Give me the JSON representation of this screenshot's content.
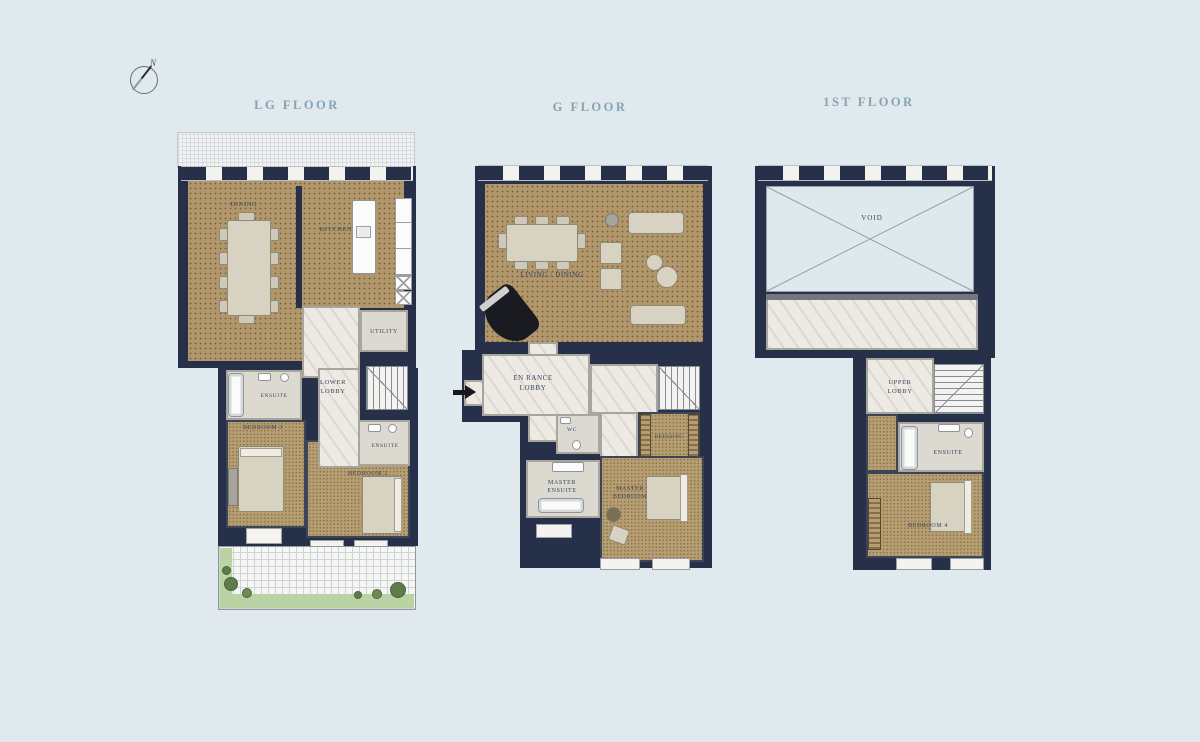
{
  "compass": {
    "north_label": "N"
  },
  "floors": {
    "lg": {
      "title": "LG FLOOR",
      "rooms": {
        "dining": "DINING",
        "kitchen": "KITCHEN",
        "utility": "UTILITY",
        "lower_lobby": "LOWER LOBBY",
        "ensuite_left": "ENSUITE",
        "bedroom_3": "BEDROOM 3",
        "ensuite_right": "ENSUITE",
        "bedroom_2": "BEDROOM 2"
      }
    },
    "g": {
      "title": "G FLOOR",
      "rooms": {
        "living_dining": "LIVING / DINING",
        "entrance_lobby_line1": "EN RANCE",
        "entrance_lobby_line2": "LOBBY",
        "wc": "WC",
        "dressing": "DRESSING",
        "master_ensuite": "MASTER ENSUITE",
        "master_bedroom": "MASTER BEDROOM"
      }
    },
    "first": {
      "title": "1ST FLOOR",
      "rooms": {
        "void": "VOID",
        "upper_lobby": "UPPER LOBBY",
        "ensuite": "ENSUITE",
        "bedroom_4": "BEDROOM 4"
      }
    }
  },
  "colors": {
    "background": "#dfe9ee",
    "wall": "#273049",
    "wood_floor": "#b1976b",
    "marble": "#edeae3",
    "lawn": "#bad3a4",
    "title_text": "#87a2b2",
    "label_text": "#39465c"
  }
}
